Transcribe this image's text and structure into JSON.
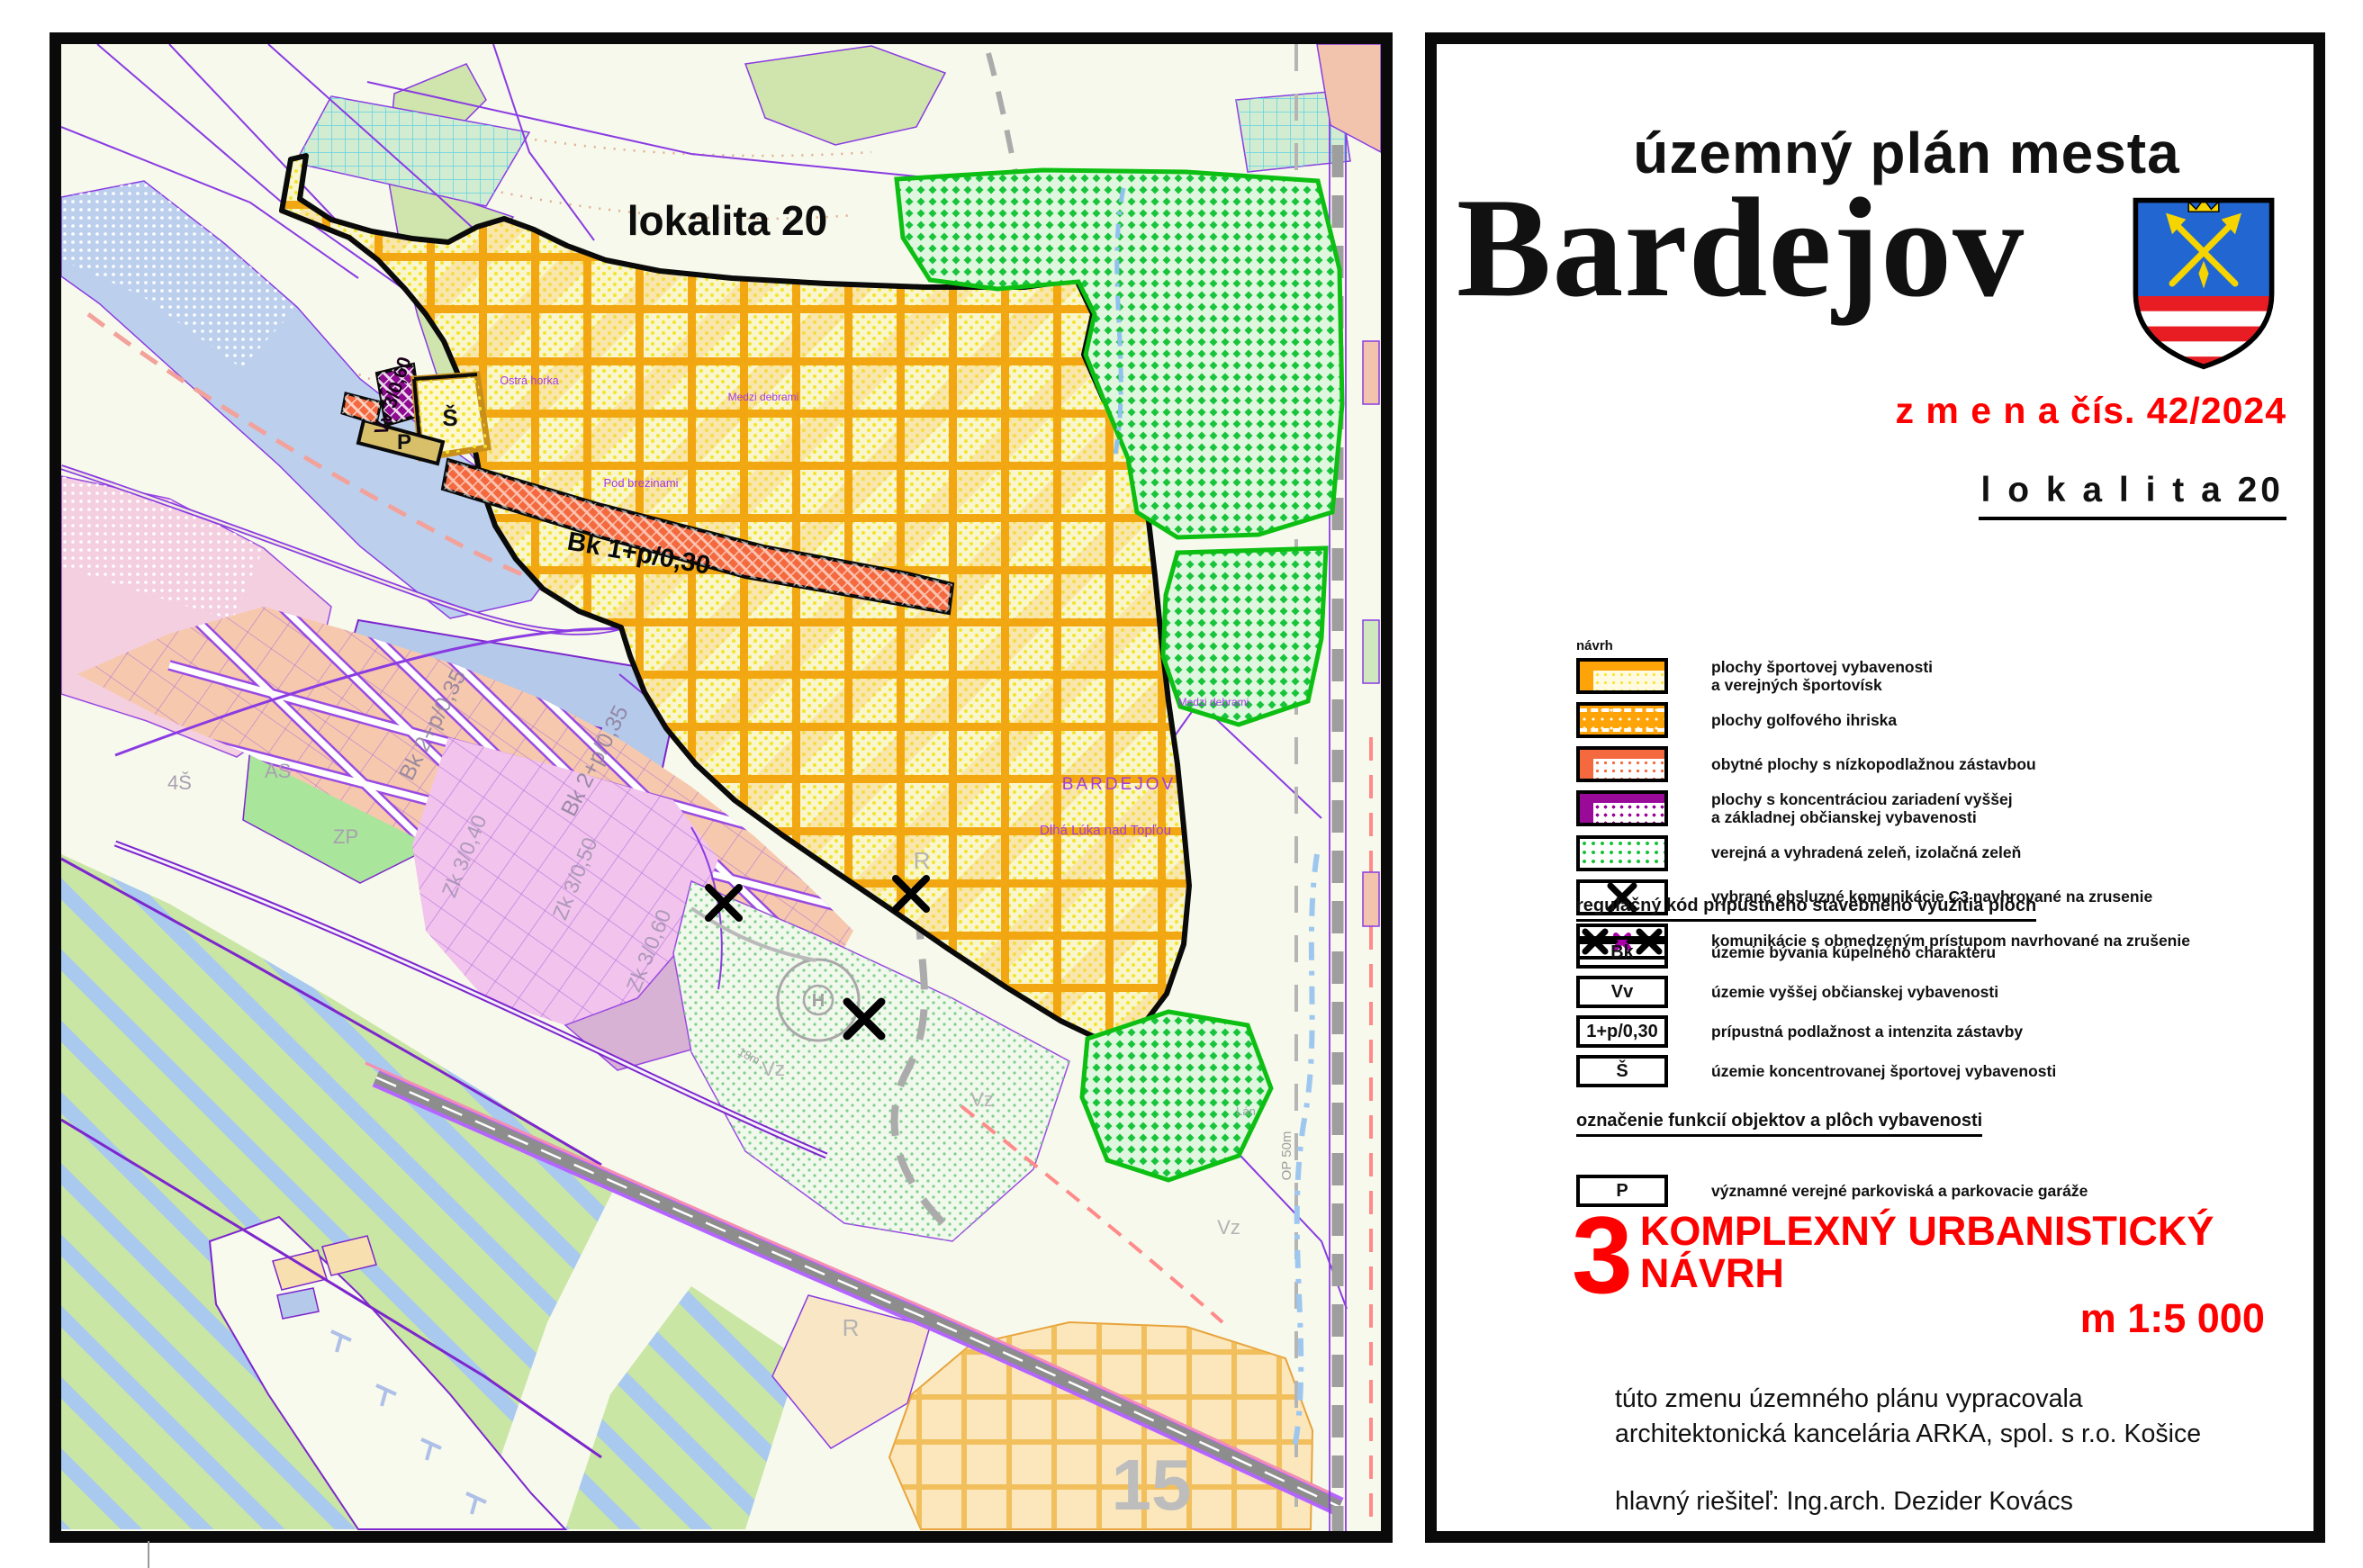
{
  "colors": {
    "accent_red": "#ff0000",
    "sport_orange": "#ffa408",
    "residential_red": "#f4693e",
    "public_purple": "#990a99",
    "green": "#17c43a",
    "golf_grid_orange": "#f2a30a",
    "road_purple": "#8a3be2"
  },
  "panel": {
    "title_small": "územný plán mesta",
    "title_city": "Bardejov",
    "change_label": "z m e n a  čís. 42/2024",
    "locality_label": "l o k a l i t a  20",
    "legend_title": "návrh",
    "legend": [
      {
        "lines": [
          "plochy športovej vybavenosti",
          "a  verejných športovísk"
        ]
      },
      {
        "lines": [
          "plochy golfového ihriska"
        ]
      },
      {
        "lines": [
          "obytné plochy s nízkopodlažnou zástavbou"
        ]
      },
      {
        "lines": [
          "plochy s  koncentráciou zariadení  vyššej",
          "a základnej občianskej vybavenosti"
        ]
      },
      {
        "lines": [
          "verejná a vyhradená zeleň, izolačná zeleň"
        ]
      },
      {
        "lines": [
          "vybrané obsluzné komunikácie C3 navhrované na zrusenie"
        ]
      },
      {
        "lines": [
          "komunikácie s obmedzeným prístupom navrhované na zrušenie"
        ]
      }
    ],
    "codes_heading": "regulačný kód prípustného stavebného využitia plôch",
    "codes": [
      {
        "code": "Bk",
        "label": "územie bývania kúpelného charakteru"
      },
      {
        "code": "Vv",
        "label": "územie vyššej občianskej vybavenosti"
      },
      {
        "code": "1+p/0,30",
        "label": "prípustná podlažnost a intenzita zástavby"
      },
      {
        "code": "Š",
        "label": "územie koncentrovanej športovej vybavenosti"
      }
    ],
    "functions_heading": "označenie funkcií objektov a plôch vybavenosti",
    "functions": [
      {
        "code": "P",
        "label": "významné verejné parkoviská a parkovacie garáže"
      }
    ],
    "footer": {
      "number": "3",
      "title": "KOMPLEXNÝ URBANISTICKÝ NÁVRH",
      "scale": "m 1:5 000",
      "credit1": "túto zmenu územného plánu vypracovala",
      "credit2": "architektonická kancelária ARKA, spol. s r.o. Košice",
      "credit3": "hlavný riešiteľ: Ing.arch. Dezider Kovács",
      "credit4": "dátum vypracovania: 2024"
    }
  },
  "map": {
    "title": "lokalita 20",
    "zone_codes": {
      "vv": "Vv 3/0,60",
      "sport": "Š",
      "parking": "P",
      "bk_strip": "Bk 1+p/0,30",
      "bk_res_a": "Bk 2+p/0,35",
      "bk_res_b": "Bk 2+p/0,35",
      "zk40": "Zk 3/0,40",
      "zk50": "Zk 3/0,50",
      "zk60": "Zk 3/0,60",
      "as": "AS",
      "zp": "ZP",
      "s4": "4Š"
    },
    "place_names": {
      "city": "BARDEJOV",
      "district": "Dlhá Lúka nad Topľou",
      "hill1": "Ostrá horka",
      "hill2": "Pod brezinami",
      "field1": "Medzi debrami",
      "field2": "Medzi debrami",
      "field3": "Lán"
    },
    "misc_labels": {
      "sheet_number": "15",
      "r1": "R",
      "r2": "R",
      "vz1": "Vz",
      "vz2": "Vz",
      "vz3": "Vz",
      "op": "OP 50m",
      "road_width": "18m",
      "heliport": "H"
    }
  }
}
